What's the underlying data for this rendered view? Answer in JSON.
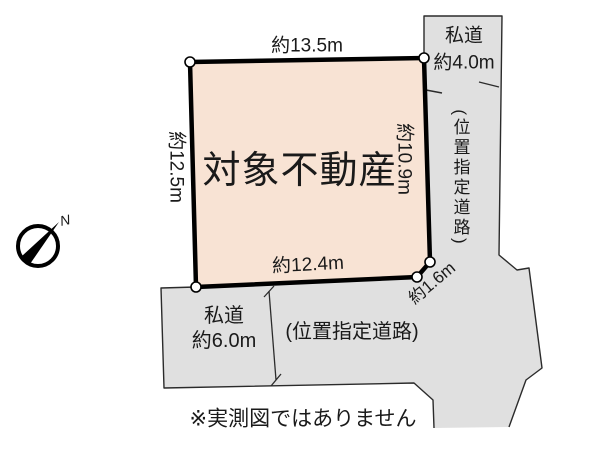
{
  "diagram": {
    "parcel": {
      "label": "対象不動産",
      "fill": "#f8e3d4"
    },
    "dimensions": {
      "top": "約13.5m",
      "left": "約12.5m",
      "right": "約10.9m",
      "bottom": "約12.4m",
      "chamfer": "約1.6m"
    },
    "roads": {
      "fill": "#e0e0e0",
      "top": {
        "name": "私道",
        "width": "約4.0m",
        "type": "(位置指定道路)"
      },
      "bottom": {
        "name": "私道",
        "width": "約6.0m",
        "type": "(位置指定道路)"
      }
    },
    "compass": {
      "north_label": "N"
    },
    "disclaimer": "※実測図ではありません"
  }
}
